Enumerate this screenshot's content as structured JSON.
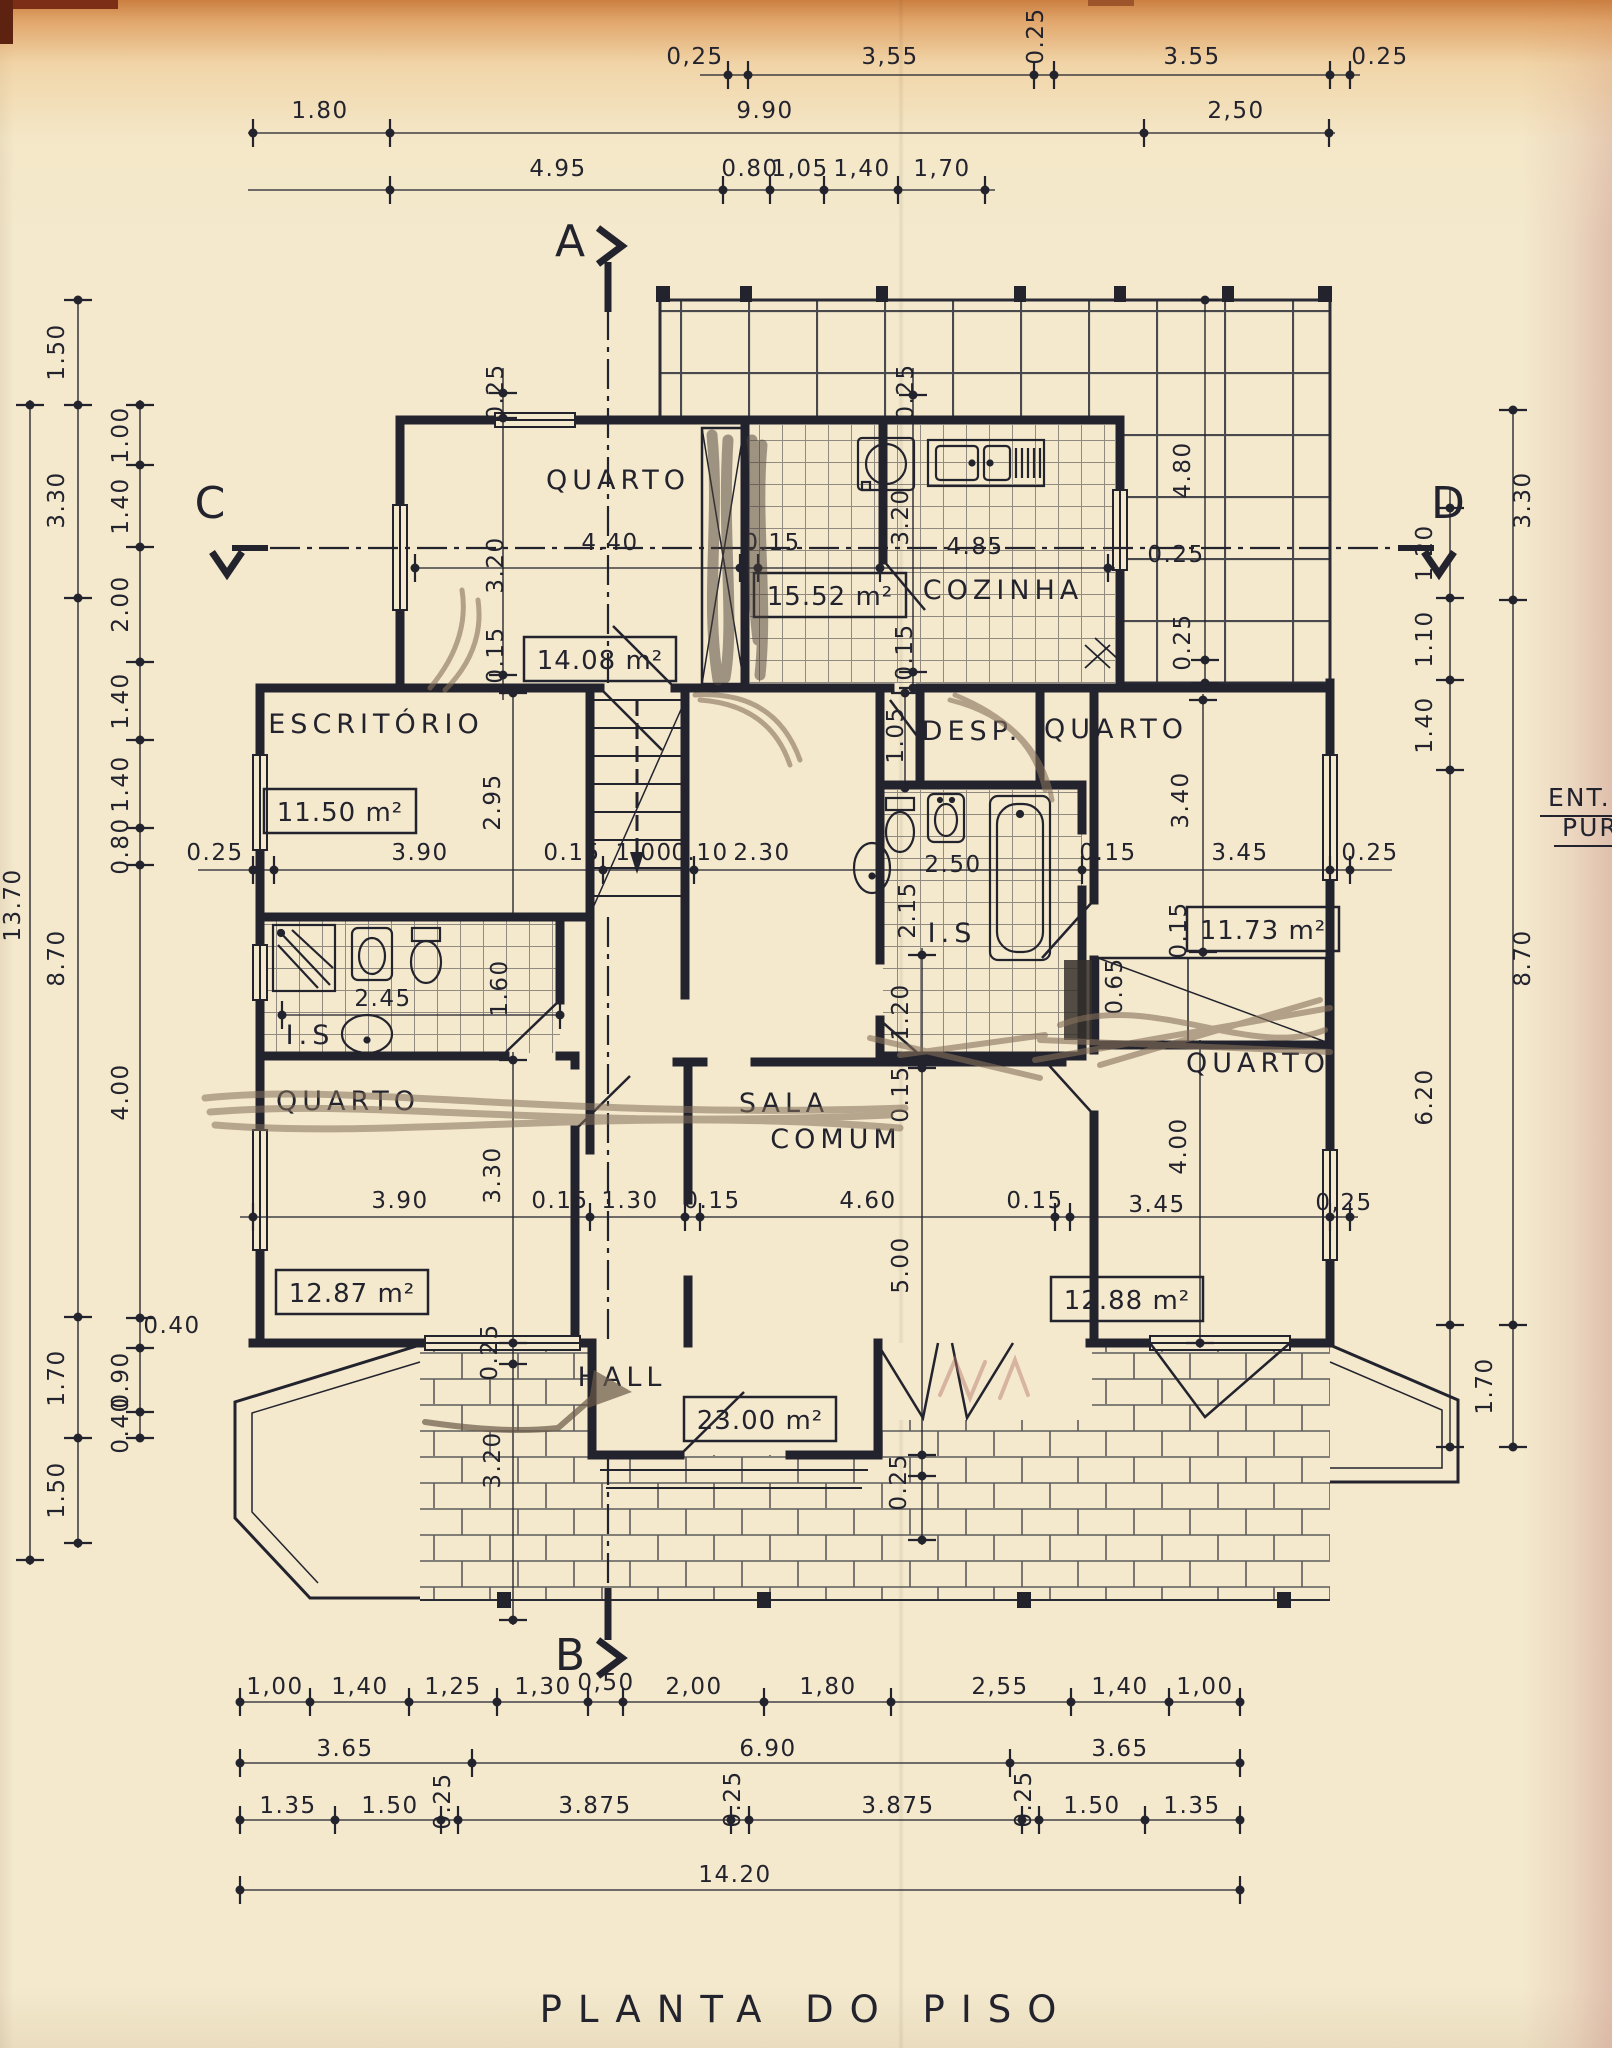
{
  "title": "PLANTA  DO  PISO",
  "colors": {
    "paper": "#f4e9cd",
    "ink": "#23232e",
    "pencil": "#85705a",
    "pencil_dark": "#4a4038",
    "red_pencil": "#b5766a"
  },
  "side_note": {
    "line1": "ENT. A",
    "line2": "PURG"
  },
  "section_markers": [
    {
      "t": "A",
      "x": 570,
      "y": 256
    },
    {
      "t": "B",
      "x": 570,
      "y": 1670
    },
    {
      "t": "C",
      "x": 210,
      "y": 518
    },
    {
      "t": "D",
      "x": 1448,
      "y": 518
    }
  ],
  "rooms": [
    {
      "name": "QUARTO",
      "area": "14.08 m²",
      "area_xy": [
        600,
        660
      ],
      "lines": [
        [
          "QUARTO",
          618,
          489
        ]
      ]
    },
    {
      "name": "COZINHA",
      "area": "15.52 m²",
      "area_xy": [
        830,
        596
      ],
      "lines": [
        [
          "COZINHA",
          1003,
          599
        ]
      ]
    },
    {
      "name": "ESCRITÓRIO",
      "area": "11.50 m²",
      "area_xy": [
        340,
        812
      ],
      "lines": [
        [
          "ESCRITÓRIO",
          376,
          733
        ]
      ]
    },
    {
      "name": "DESP.",
      "area": null,
      "area_xy": null,
      "lines": [
        [
          "DESP.",
          972,
          740
        ]
      ]
    },
    {
      "name": "QUARTO",
      "area": "11.73 m²",
      "area_xy": [
        1263,
        930
      ],
      "lines": [
        [
          "QUARTO",
          1116,
          738
        ]
      ]
    },
    {
      "name": "QUARTO",
      "area": "12.87 m²",
      "area_xy": [
        352,
        1293
      ],
      "lines": [
        [
          "QUARTO",
          348,
          1110
        ]
      ]
    },
    {
      "name": "SALA COMUM",
      "area": "23.00 m²",
      "area_xy": [
        760,
        1420
      ],
      "lines": [
        [
          "SALA",
          784,
          1112
        ],
        [
          "COMUM",
          836,
          1148
        ]
      ]
    },
    {
      "name": "QUARTO",
      "area": "12.88 m²",
      "area_xy": [
        1127,
        1300
      ],
      "lines": [
        [
          "QUARTO",
          1258,
          1072
        ]
      ]
    },
    {
      "name": "HALL",
      "area": null,
      "area_xy": null,
      "lines": [
        [
          "HALL",
          622,
          1386
        ]
      ]
    },
    {
      "name": "I.S",
      "area": null,
      "area_xy": null,
      "lines": [
        [
          "I.S",
          310,
          1044
        ]
      ]
    },
    {
      "name": "I.S",
      "area": null,
      "area_xy": null,
      "lines": [
        [
          "I.S",
          952,
          942
        ]
      ]
    }
  ],
  "dim_labels": [
    [
      "0,25",
      695,
      64
    ],
    [
      "3,55",
      890,
      64
    ],
    [
      "0.25",
      1043,
      36,
      -90
    ],
    [
      "3.55",
      1192,
      64
    ],
    [
      "0.25",
      1380,
      64
    ],
    [
      "1.80",
      320,
      118
    ],
    [
      "9.90",
      765,
      118
    ],
    [
      "2,50",
      1236,
      118
    ],
    [
      "4.95",
      558,
      176
    ],
    [
      "0.80",
      750,
      176
    ],
    [
      "1,05",
      800,
      176
    ],
    [
      "1,40",
      862,
      176
    ],
    [
      "1,70",
      942,
      176
    ],
    [
      "13.70",
      20,
      905,
      -90
    ],
    [
      "1.50",
      64,
      352,
      -90
    ],
    [
      "3.30",
      64,
      500,
      -90
    ],
    [
      "8.70",
      64,
      958,
      -90
    ],
    [
      "1.70",
      64,
      1378,
      -90
    ],
    [
      "1.50",
      64,
      1490,
      -90
    ],
    [
      "1.00",
      128,
      435,
      -90
    ],
    [
      "1.40",
      128,
      506,
      -90
    ],
    [
      "2.00",
      128,
      604,
      -90
    ],
    [
      "1.40",
      128,
      701,
      -90
    ],
    [
      "1.40",
      128,
      784,
      -90
    ],
    [
      "0.80",
      128,
      846,
      -90
    ],
    [
      "4.00",
      128,
      1092,
      -90
    ],
    [
      "0.40",
      172,
      1333
    ],
    [
      "0.90",
      128,
      1380,
      -90
    ],
    [
      "0.40",
      128,
      1425,
      -90
    ],
    [
      "3.30",
      1530,
      500,
      -90
    ],
    [
      "8.70",
      1530,
      958,
      -90
    ],
    [
      "1.70",
      1492,
      1386,
      -90
    ],
    [
      "1.20",
      1432,
      553,
      -90
    ],
    [
      "1.10",
      1432,
      639,
      -90
    ],
    [
      "1.40",
      1432,
      725,
      -90
    ],
    [
      "6.20",
      1432,
      1097,
      -90
    ],
    [
      "0.25",
      215,
      860
    ],
    [
      "3.90",
      420,
      860
    ],
    [
      "0.15",
      572,
      860
    ],
    [
      "1.00",
      644,
      860
    ],
    [
      "0.10",
      700,
      860
    ],
    [
      "2.30",
      762,
      860
    ],
    [
      "2.50",
      953,
      872
    ],
    [
      "0.15",
      1108,
      860
    ],
    [
      "3.45",
      1240,
      860
    ],
    [
      "0.25",
      1370,
      860
    ],
    [
      "0.25",
      503,
      392,
      -90
    ],
    [
      "3.20",
      503,
      565,
      -90
    ],
    [
      "4.40",
      610,
      550
    ],
    [
      "0.15",
      772,
      550
    ],
    [
      "0.15",
      503,
      655,
      -90
    ],
    [
      "0.25",
      913,
      392,
      -90
    ],
    [
      "3.20",
      908,
      517,
      -90
    ],
    [
      "4.85",
      975,
      554
    ],
    [
      "0.15",
      912,
      652,
      -90
    ],
    [
      "4.80",
      1190,
      470,
      -90
    ],
    [
      "0.25",
      1176,
      562
    ],
    [
      "0.25",
      1190,
      642,
      -90
    ],
    [
      "2.95",
      500,
      802,
      -90
    ],
    [
      "1.05",
      903,
      735,
      -90
    ],
    [
      "3.40",
      1188,
      800,
      -90
    ],
    [
      "0.15",
      1186,
      930,
      -90
    ],
    [
      "0.65",
      1122,
      986,
      -90
    ],
    [
      "2.45",
      383,
      1006
    ],
    [
      "1.60",
      507,
      988,
      -90
    ],
    [
      "2.15",
      915,
      910,
      -90
    ],
    [
      "1.20",
      908,
      1012,
      -90
    ],
    [
      "0.15",
      908,
      1094,
      -90
    ],
    [
      "5.00",
      908,
      1265,
      -90
    ],
    [
      "0.25",
      906,
      1482,
      -90
    ],
    [
      "3.30",
      500,
      1175,
      -90
    ],
    [
      "0.25",
      497,
      1352,
      -90
    ],
    [
      "3.20",
      500,
      1460,
      -90
    ],
    [
      "4.00",
      1186,
      1146,
      -90
    ],
    [
      "3.90",
      400,
      1208
    ],
    [
      "0.15",
      560,
      1208
    ],
    [
      "1.30",
      630,
      1208
    ],
    [
      "0.15",
      712,
      1208
    ],
    [
      "4.60",
      868,
      1208
    ],
    [
      "0.15",
      1035,
      1208
    ],
    [
      "3.45",
      1157,
      1212
    ],
    [
      "0,25",
      1344,
      1210
    ],
    [
      "1,00",
      275,
      1694
    ],
    [
      "1,40",
      360,
      1694
    ],
    [
      "1,25",
      453,
      1694
    ],
    [
      "1,30",
      543,
      1694
    ],
    [
      "0,50",
      606,
      1690
    ],
    [
      "2,00",
      694,
      1694
    ],
    [
      "1,80",
      828,
      1694
    ],
    [
      "2,55",
      1000,
      1694
    ],
    [
      "1,40",
      1120,
      1694
    ],
    [
      "1,00",
      1205,
      1694
    ],
    [
      "3.65",
      345,
      1756
    ],
    [
      "6.90",
      768,
      1756
    ],
    [
      "3.65",
      1120,
      1756
    ],
    [
      "1.35",
      288,
      1813
    ],
    [
      "1.50",
      390,
      1813
    ],
    [
      "0.25",
      450,
      1801,
      -90
    ],
    [
      "3.875",
      595,
      1813
    ],
    [
      "0.25",
      740,
      1799,
      -90
    ],
    [
      "3.875",
      898,
      1813
    ],
    [
      "0.25",
      1031,
      1799,
      -90
    ],
    [
      "1.50",
      1092,
      1813
    ],
    [
      "1.35",
      1192,
      1813
    ],
    [
      "14.20",
      735,
      1882
    ]
  ],
  "chains": [
    {
      "o": "h",
      "pos": 75,
      "a": 700,
      "b": 1360,
      "ticks": [
        728,
        748,
        1034,
        1054,
        1330,
        1350
      ]
    },
    {
      "o": "h",
      "pos": 133,
      "a": 248,
      "b": 1335,
      "ticks": [
        253,
        390,
        1144,
        1329
      ]
    },
    {
      "o": "h",
      "pos": 190,
      "a": 248,
      "b": 995,
      "ticks": [
        390,
        723,
        770,
        824,
        898,
        985
      ]
    },
    {
      "o": "h",
      "pos": 568,
      "a": 415,
      "b": 1115,
      "ticks": [
        415,
        740,
        758,
        880,
        1108
      ]
    },
    {
      "o": "h",
      "pos": 870,
      "a": 198,
      "b": 1392,
      "ticks": [
        253,
        274,
        590,
        603,
        685,
        694,
        880,
        1082,
        1094,
        1330,
        1350
      ]
    },
    {
      "o": "h",
      "pos": 1015,
      "a": 280,
      "b": 562,
      "ticks": [
        282,
        560
      ]
    },
    {
      "o": "h",
      "pos": 1217,
      "a": 240,
      "b": 1358,
      "ticks": [
        253,
        575,
        590,
        685,
        700,
        1055,
        1070,
        1330,
        1350
      ]
    },
    {
      "o": "h",
      "pos": 1702,
      "a": 238,
      "b": 1242,
      "ticks": [
        240,
        310,
        409,
        497,
        588,
        623,
        764,
        891,
        1071,
        1169,
        1240
      ]
    },
    {
      "o": "h",
      "pos": 1763,
      "a": 238,
      "b": 1242,
      "ticks": [
        240,
        472,
        1010,
        1240
      ]
    },
    {
      "o": "h",
      "pos": 1820,
      "a": 238,
      "b": 1242,
      "ticks": [
        240,
        335,
        441,
        458,
        731,
        749,
        1022,
        1039,
        1145,
        1240
      ]
    },
    {
      "o": "h",
      "pos": 1890,
      "a": 238,
      "b": 1242,
      "ticks": [
        240,
        1240
      ]
    },
    {
      "o": "v",
      "pos": 30,
      "a": 400,
      "b": 1565,
      "ticks": [
        405,
        1560
      ]
    },
    {
      "o": "v",
      "pos": 78,
      "a": 296,
      "b": 1548,
      "ticks": [
        300,
        405,
        598,
        1317,
        1438,
        1543
      ]
    },
    {
      "o": "v",
      "pos": 140,
      "a": 400,
      "b": 1442,
      "ticks": [
        405,
        465,
        547,
        662,
        740,
        828,
        865,
        1318,
        1348,
        1412,
        1438
      ]
    },
    {
      "o": "v",
      "pos": 1450,
      "a": 488,
      "b": 1450,
      "ticks": [
        508,
        598,
        680,
        770,
        1325,
        1447
      ]
    },
    {
      "o": "v",
      "pos": 1513,
      "a": 406,
      "b": 1450,
      "ticks": [
        410,
        600,
        1325,
        1447
      ]
    },
    {
      "o": "v",
      "pos": 503,
      "a": 368,
      "b": 700,
      "ticks": [
        393,
        418,
        675,
        690
      ]
    },
    {
      "o": "v",
      "pos": 913,
      "a": 368,
      "b": 688,
      "ticks": [
        395,
        420,
        672,
        688
      ]
    },
    {
      "o": "v",
      "pos": 1205,
      "a": 296,
      "b": 686,
      "ticks": [
        300,
        660,
        683
      ]
    },
    {
      "o": "v",
      "pos": 513,
      "a": 690,
      "b": 920,
      "ticks": [
        693,
        917
      ]
    },
    {
      "o": "v",
      "pos": 513,
      "a": 1052,
      "b": 1625,
      "ticks": [
        1060,
        1343,
        1364,
        1620
      ]
    },
    {
      "o": "v",
      "pos": 922,
      "a": 948,
      "b": 1545,
      "ticks": [
        955,
        1056,
        1068,
        1455,
        1476,
        1540
      ]
    },
    {
      "o": "v",
      "pos": 1203,
      "a": 694,
      "b": 958,
      "ticks": [
        700,
        952
      ]
    },
    {
      "o": "v",
      "pos": 1200,
      "a": 1040,
      "b": 1348,
      "ticks": [
        1045,
        1343
      ]
    },
    {
      "o": "v",
      "pos": 905,
      "a": 688,
      "b": 792,
      "ticks": [
        693,
        788
      ]
    }
  ]
}
